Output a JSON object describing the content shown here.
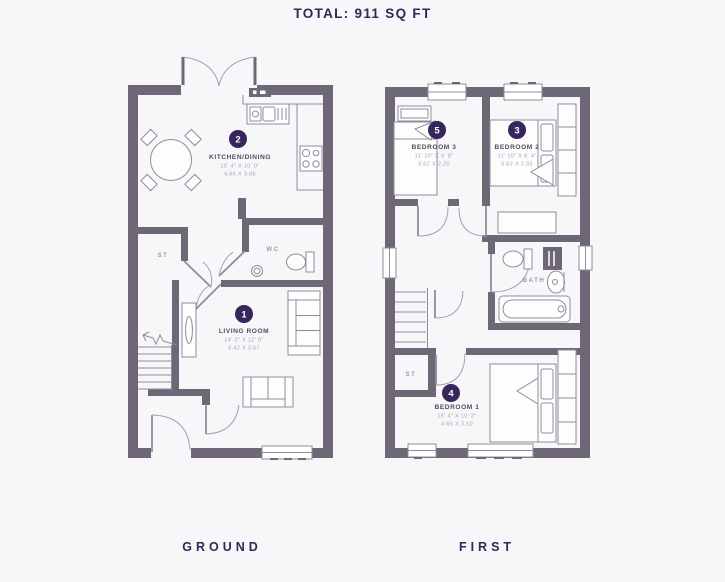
{
  "title": "TOTAL: 911 SQ FT",
  "floor_labels": {
    "ground": "GROUND",
    "first": "FIRST"
  },
  "colors": {
    "background": "#f7f7f9",
    "wall": "#6e6876",
    "thin_line": "#8f8c99",
    "badge": "#37265c",
    "room_name": "#514c5c",
    "dimensions": "#a7a4b0",
    "heading": "#2d2a56",
    "small_label": "#9b98a6"
  },
  "ground": {
    "kitchen": {
      "badge": "2",
      "name": "KITCHEN/DINING",
      "imperial": "15' 4\" X 10' 0\"",
      "metric": "4.66 X 3.06"
    },
    "living": {
      "badge": "1",
      "name": "LIVING ROOM",
      "imperial": "14' 2\" X 12' 0\"",
      "metric": "4.42 X 3.67"
    },
    "wc_label": "WC",
    "st_label": "ST"
  },
  "first": {
    "bedroom3": {
      "badge": "5",
      "name": "BEDROOM 3",
      "imperial": "11' 10\" X 6' 8\"",
      "metric": "3.62 X 2.20"
    },
    "bedroom2": {
      "badge": "3",
      "name": "BEDROOM 2",
      "imperial": "11' 10\" X 8' 4\"",
      "metric": "3.62 X 2.55"
    },
    "bedroom1": {
      "badge": "4",
      "name": "BEDROOM 1",
      "imperial": "15' 4\" X 10' 2\"",
      "metric": "4.66 X 3.10"
    },
    "bath_label": "BATH",
    "st_label": "ST"
  }
}
